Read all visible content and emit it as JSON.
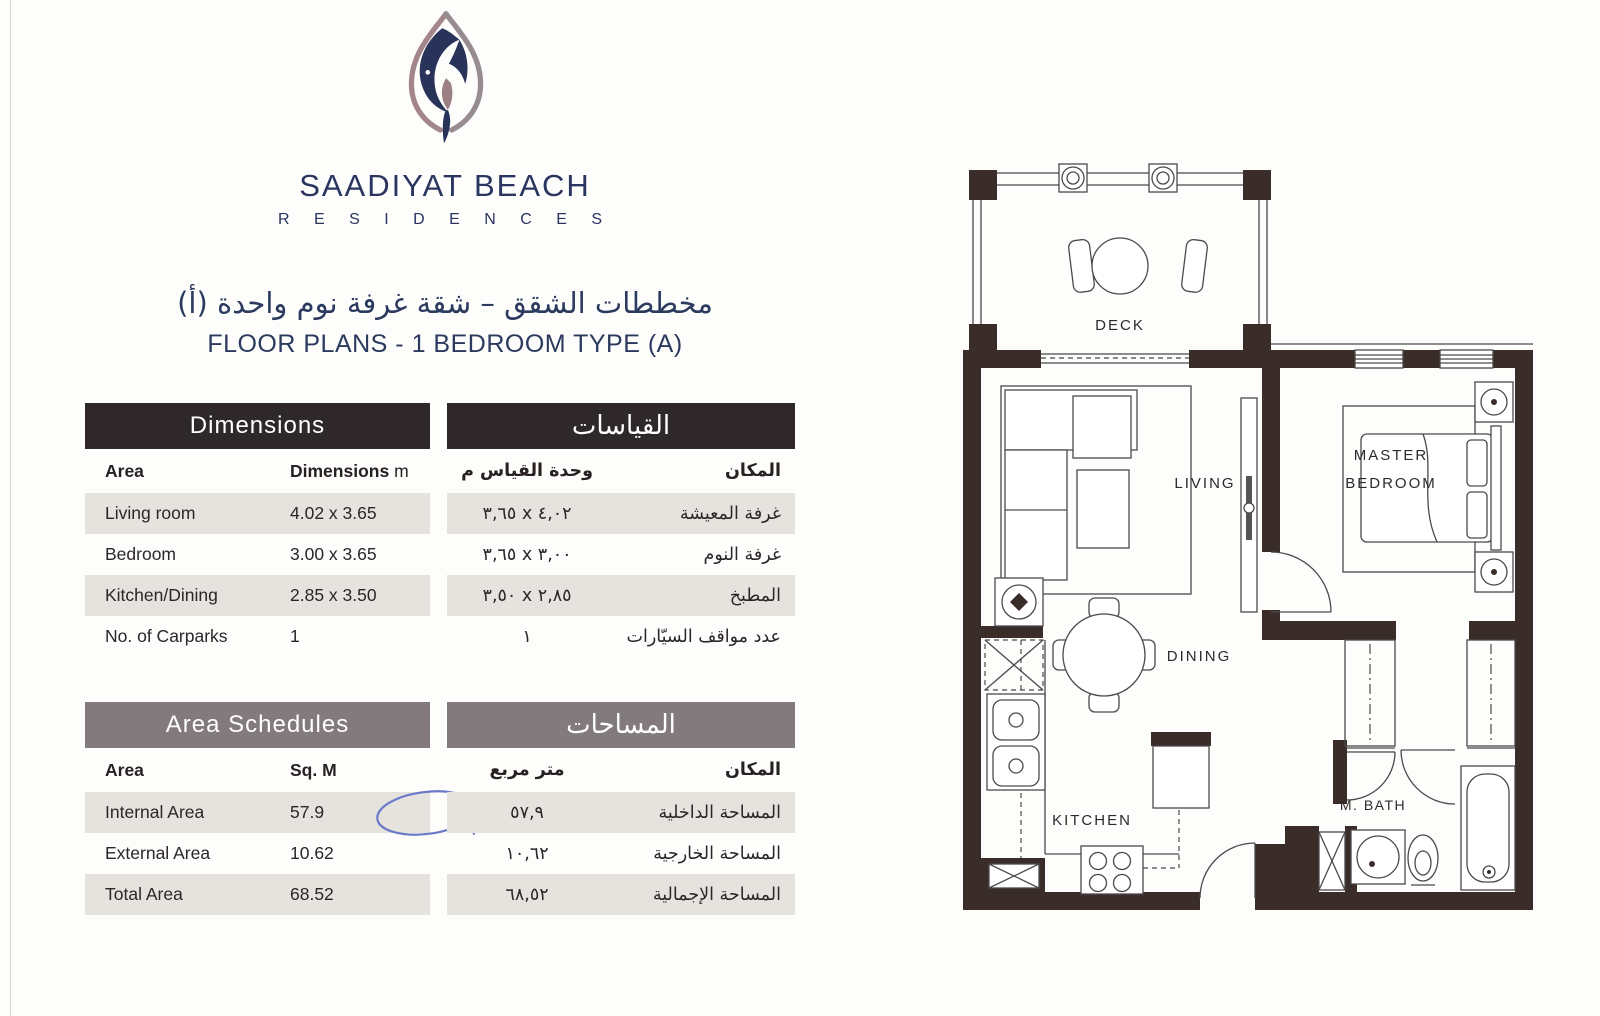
{
  "brand": {
    "name_line1": "SAADIYAT BEACH",
    "name_line2": "R E S I D E N C E S"
  },
  "titles": {
    "arabic": "مخططات الشقق – شقة غرفة نوم واحدة (أ)",
    "english": "FLOOR PLANS - 1 BEDROOM TYPE (A)"
  },
  "dimensions_table": {
    "header": "Dimensions",
    "col_area": "Area",
    "col_value": "Dimensions",
    "col_value_unit": "m",
    "rows": [
      {
        "area": "Living room",
        "value": "4.02 x 3.65"
      },
      {
        "area": "Bedroom",
        "value": "3.00 x 3.65"
      },
      {
        "area": "Kitchen/Dining",
        "value": "2.85 x 3.50"
      },
      {
        "area": "No. of Carparks",
        "value": "1"
      }
    ]
  },
  "dimensions_table_ar": {
    "header": "القياسات",
    "col_area": "المكان",
    "col_value": "وحدة القياس م",
    "rows": [
      {
        "area": "غرفة المعيشة",
        "value": "٣,٦٥ x ٤,٠٢"
      },
      {
        "area": "غرفة النوم",
        "value": "٣,٦٥ x ٣,٠٠"
      },
      {
        "area": "المطبخ",
        "value": "٣,٥٠ x ٢,٨٥"
      },
      {
        "area": "عدد مواقف السيّارات",
        "value": "١"
      }
    ]
  },
  "areas_table": {
    "header": "Area Schedules",
    "col_area": "Area",
    "col_value": "Sq. M",
    "rows": [
      {
        "area": "Internal Area",
        "value": "57.9"
      },
      {
        "area": "External Area",
        "value": "10.62"
      },
      {
        "area": "Total Area",
        "value": "68.52"
      }
    ]
  },
  "areas_table_ar": {
    "header": "المساحات",
    "col_area": "المكان",
    "col_value": "متر مربع",
    "rows": [
      {
        "area": "المساحة الداخلية",
        "value": "٥٧,٩"
      },
      {
        "area": "المساحة الخارجية",
        "value": "١٠,٦٢"
      },
      {
        "area": "المساحة الإجمالية",
        "value": "٦٨,٥٢"
      }
    ]
  },
  "floor_plan": {
    "labels": {
      "deck": "DECK",
      "living": "LIVING",
      "master_line1": "MASTER",
      "master_line2": "BEDROOM",
      "dining": "DINING",
      "kitchen": "KITCHEN",
      "bath": "M. BATH"
    }
  },
  "colors": {
    "navy": "#2b3a5e",
    "header_dark": "#2e282b",
    "header_gray": "#837a7d",
    "row_shade": "#e6e3de",
    "wall_brown": "#3a2c29",
    "logo_mauve": "#a3868b",
    "pen_blue": "#6b79c8"
  }
}
